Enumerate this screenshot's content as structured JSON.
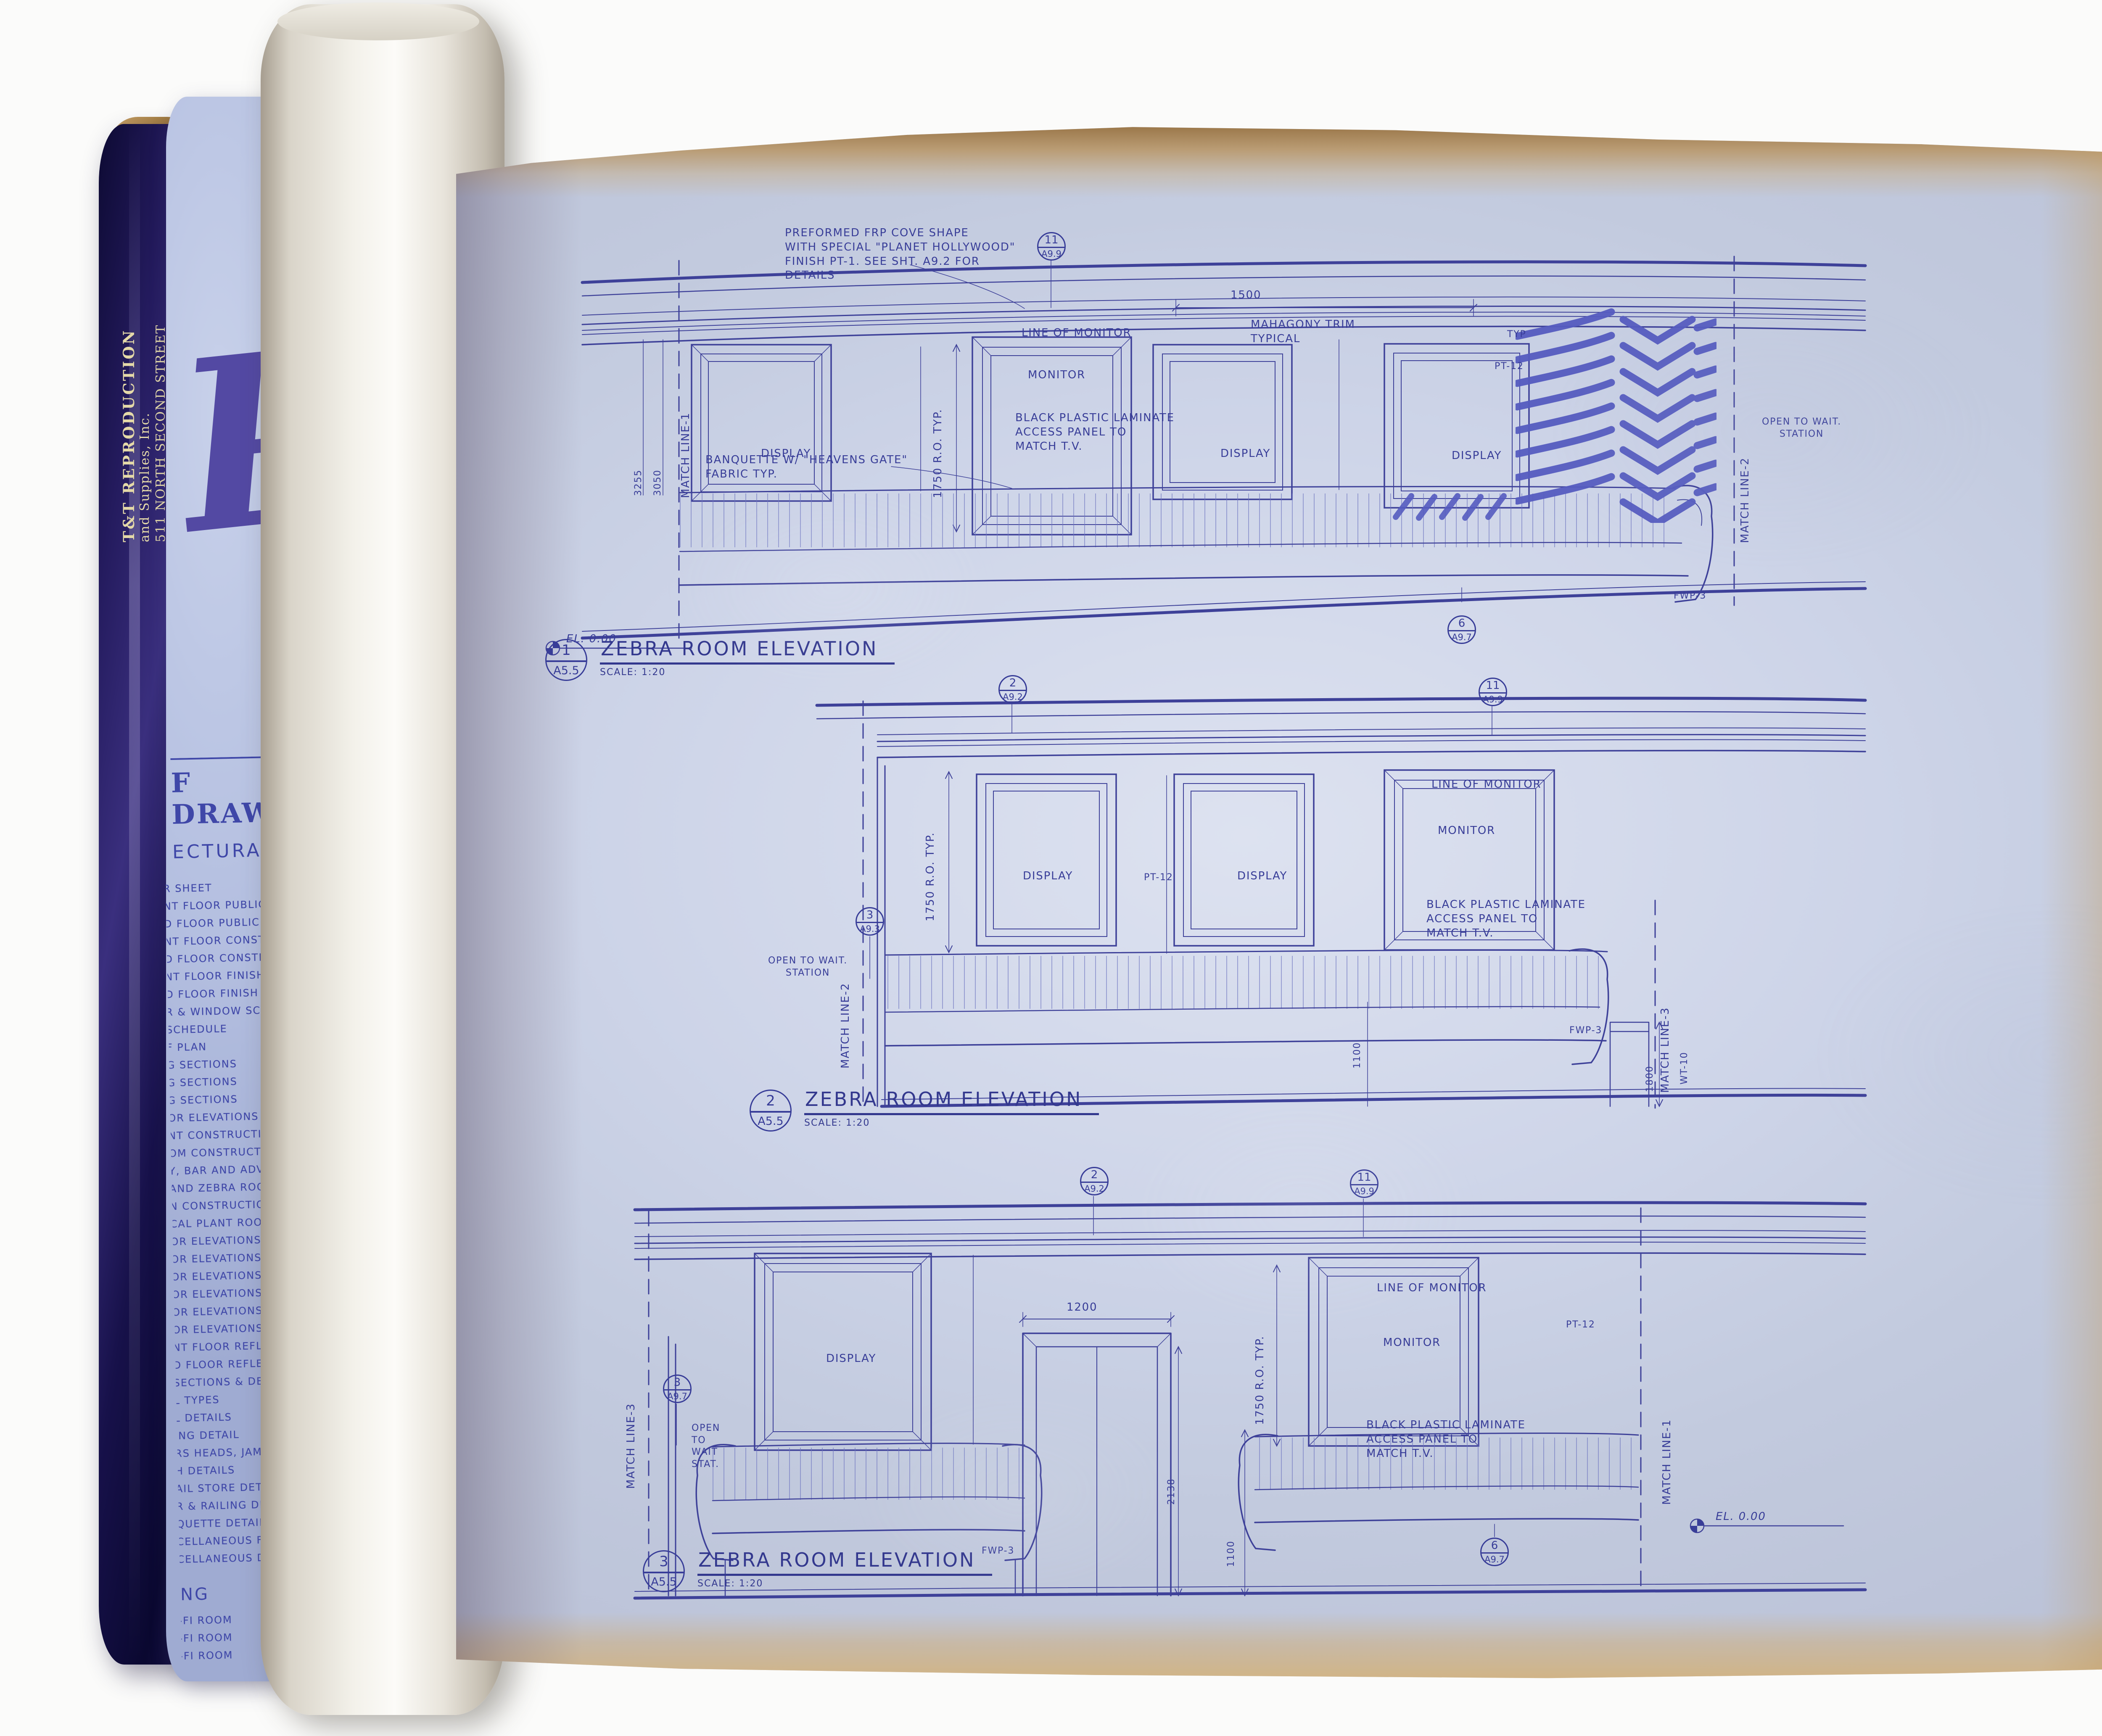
{
  "scene": {
    "tube_label_lines": [
      "T&T REPRODUCTION",
      "and Supplies, Inc.",
      "511 NORTH SECOND STREET",
      "LIBERTYVILLE, IL 60048"
    ],
    "logo_fragment": "PL",
    "index_roll": {
      "header_fragment": "F DRAWING",
      "subheader_fragment": "ECTURAL",
      "items": [
        "R SHEET",
        "NT FLOOR PUBLIC ASSEMBL",
        "D FLOOR PUBLIC ASSEMBLY",
        "NT FLOOR CONSTRUCTION",
        "D FLOOR CONSTRUCTION PL",
        "NT FLOOR FINISH PLAN",
        "D FLOOR FINISH PLAN",
        "R & WINDOW SCHEDULE & DET",
        "SCHEDULE",
        "F PLAN",
        "G SECTIONS",
        "G SECTIONS",
        "G SECTIONS",
        "OR ELEVATIONS",
        "NT CONSTRUCTION PLAN",
        "OM CONSTRUCTION PLAN",
        "Y, BAR AND ADVENTURE RO",
        "AND ZEBRA ROOM CONST",
        "N CONSTRUCTION PLAN",
        "CAL PLANT ROOM PLAN",
        "OR ELEVATIONS - ENTRY",
        "OR ELEVATIONS - RETAIL",
        "OR ELEVATIONS - SKYROO",
        "OR ELEVATIONS - BAR",
        "OR ELEVATIONS - ZEBRA",
        "OR ELEVATIONS - BATHR",
        "NT FLOOR REFLECTED C",
        "D FLOOR REFLECTED CEI",
        "SECTIONS & DETAILS",
        "L TYPES",
        "L DETAILS",
        "ING DETAIL",
        "RS HEADS, JAMBS DETAILS",
        "H DETAILS",
        "AIL STORE DETAILS",
        "R & RAILING DETAILS",
        "QUETTE DETAILS",
        "CELLANEOUS FLOOR DETAIL",
        "CELLANEOUS DETAILS"
      ],
      "section2_header": "NG",
      "section2_items": [
        "-FI ROOM",
        "-FI ROOM",
        "-FI ROOM",
        "ENTURE ROOM",
        "ENTURE ROOM",
        "CELLANEOUS DETAILS",
        "TERIOR"
      ]
    }
  },
  "labels": {
    "display": "DISPLAY",
    "monitor": "MONITOR",
    "line_of_monitor": "LINE OF MONITOR",
    "access_panel": "BLACK PLASTIC LAMINATE\nACCESS PANEL TO\nMATCH T.V.",
    "ro_1750": "1750 R.O. TYP.",
    "pt12": "PT-12",
    "typ": "TYP",
    "fwp3": "FWP-3",
    "wt10": "WT-10",
    "match_line_1": "MATCH LINE-1",
    "match_line_2": "MATCH LINE-2",
    "match_line_3": "MATCH LINE-3",
    "open_wait_station": "OPEN TO WAIT.\nSTATION",
    "open_wait_stat": "OPEN\nTO\nWAIT\nSTAT.",
    "el_datum": "EL. 0.00",
    "dim_1500": "1500",
    "dim_3255": "3255",
    "dim_3050": "3050",
    "dim_1100": "1100",
    "dim_1800": "1800",
    "dim_1200": "1200",
    "dim_2138": "2138",
    "cove_note": "PREFORMED FRP COVE SHAPE\nWITH SPECIAL \"PLANET HOLLYWOOD\"\nFINISH PT-1.  SEE SHT. A9.2 FOR\nDETAILS",
    "trim_note": "MAHAGONY TRIM\nTYPICAL",
    "banquette_note": "BANQUETTE W/ \"HEAVENS GATE\"\nFABRIC TYP."
  },
  "bubbles": {
    "b11_a99": {
      "num": "11",
      "sheet": "A9.9"
    },
    "b6_a97": {
      "num": "6",
      "sheet": "A9.7"
    },
    "b2_a92": {
      "num": "2",
      "sheet": "A9.2"
    },
    "b3_a93": {
      "num": "3",
      "sheet": "A9.3"
    },
    "b3_a97": {
      "num": "3",
      "sheet": "A9.7"
    }
  },
  "elevations": {
    "title": "ZEBRA ROOM ELEVATION",
    "scale": "SCALE: 1:20",
    "sheet": "A5.5",
    "e1_num": "1",
    "e2_num": "2",
    "e3_num": "3"
  },
  "title_block": {
    "issue_title": "DRAWING ISSUE RECORD",
    "col_status": "STATUS",
    "col_date": "DATE ISSUED",
    "rows": [
      {
        "status": "CD",
        "date": "5/21/96",
        "note": "PCP"
      },
      {
        "status": "CD",
        "date": "5-31-96",
        "note": "PH/96"
      }
    ],
    "handwritten": "MGH",
    "project_label": "PROJECT:",
    "project_name": "PLANET HOLLYWOOD",
    "project_city": "MOSCOW, RUSSIA",
    "project_no_label": "PROJECT#",
    "project_no": "96007",
    "title_label": "TITLE:",
    "title_value": "ZEBRA ROOM ELEVATIONS",
    "scale_label": "Scale:",
    "scale_value": "AS NOTED",
    "dwn_label": "Dwn by:",
    "dwn_value": "AMH",
    "checked_label": "Checked by:",
    "checked_value": "RB",
    "firm_credit": "Rockwell Architecture, Planning and Design, P.C.",
    "firm_name": "rockwellgroup",
    "firm_address": [
      "Rockwell Architecture,",
      "Planning and Design, P.C.",
      "5 Union Square West",
      "New York, New York 10003",
      "tel 212-463-0334",
      "fax 212-463-0335"
    ],
    "sheet_number": "A5.5"
  }
}
